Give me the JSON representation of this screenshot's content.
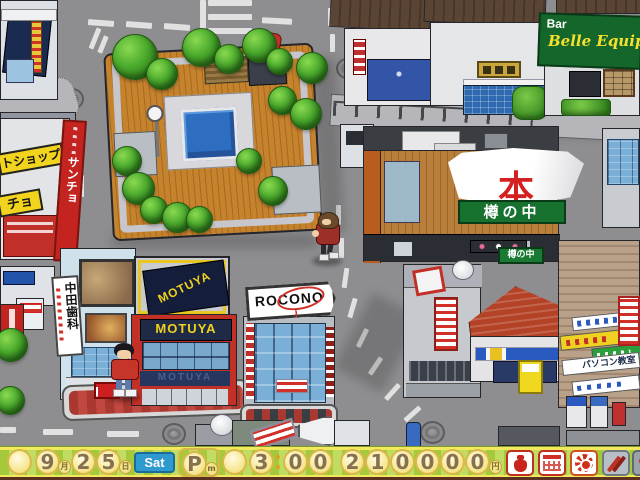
{
  "hud": {
    "date": {
      "month": "9",
      "month_unit": "月",
      "day_tens": "2",
      "day_ones": "5",
      "day_unit": "日",
      "weekday": "Sat"
    },
    "time": {
      "meridiem": "P",
      "meridiem_sub": "m",
      "hour": "3",
      "minute_tens": "0",
      "minute_ones": "0"
    },
    "money": {
      "d0": "2",
      "d1": "1",
      "d2": "0",
      "d3": "0",
      "d4": "0",
      "d5": "0",
      "unit": "円"
    },
    "toolbar_icons": [
      "money-bag-icon",
      "calendar-icon",
      "gear-icon",
      "pencil-icon",
      "pushpin-icon"
    ],
    "colors": {
      "bar_green": "#a4c93a",
      "oval_yellow": "#f5e489",
      "sat_blue": "#2f9ad0",
      "digit_brown": "#86704e"
    }
  },
  "map": {
    "signs": {
      "bar_label": "Bar",
      "bar_name": "Belle Equipe",
      "book_kanji": "本",
      "barrel_main": "樽の中",
      "barrel_small": "樽の中",
      "motuya_roof": "MOTUYA",
      "motuya_facade": "MOTUYA",
      "motuya_awning": "MOTUYA",
      "rocono": "ROCONO",
      "dental": "中田歯科",
      "petshop": "トショップ",
      "petshop2": "チョ",
      "sancho": "サンチョ",
      "pc_school": "パソコン教室",
      "stop": "とまれ"
    },
    "colors": {
      "motuya_red": "#c23028",
      "motuya_navy": "#1e2a46",
      "rocono_glass": "#7ab0d8",
      "barrel_green": "#17722f",
      "book_red": "#d42020",
      "bar_sign_green": "#15662b"
    }
  }
}
